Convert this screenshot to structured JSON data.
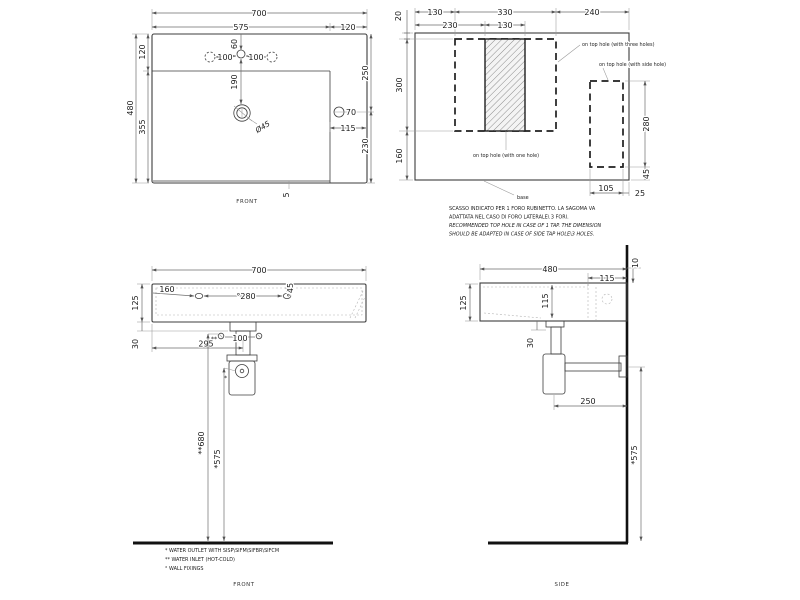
{
  "drawing": {
    "top_view": {
      "caption": "FRONT",
      "width": "700",
      "bowl_width": "575",
      "deck_width": "120",
      "tap_offset": "60",
      "tap_left": "100",
      "tap_right": "100",
      "rim_top": "120",
      "depth": "480",
      "bowl_depth": "355",
      "drain_offset": "190",
      "drain_dia": "Ø45",
      "side_hole": "70",
      "side_hole_inset": "115",
      "side_upper": "250",
      "side_lower": "230",
      "bottom_gap": "5"
    },
    "hole_view": {
      "d20": "20",
      "d130a": "130",
      "d330": "330",
      "d240": "240",
      "d230": "230",
      "d130b": "130",
      "d300": "300",
      "d160": "160",
      "d280": "280",
      "d45": "45",
      "d105": "105",
      "d25": "25",
      "label_three_holes": "on top hole (with three holes)",
      "label_side_hole": "on top hole (with side hole)",
      "label_one_hole": "on top hole (with one hole)",
      "label_base": "base",
      "note_it_1": "SCASSO INDICATO PER 1 FORO RUBINETTO. LA SAGOMA VA",
      "note_it_2": "ADATTATA NEL CASO DI FORO LATERALE\\ 3 FORI.",
      "note_en_1": "RECOMMENDED TOP HOLE IN CASE OF 1 TAP. THE DIMENSION",
      "note_en_2": "SHOULD BE ADAPTED IN CASE OF SIDE TAP HOLE\\3 HOLES."
    },
    "front_view": {
      "caption": "FRONT",
      "width": "700",
      "height": "125",
      "d30": "30",
      "d160": "160",
      "d280": "°280",
      "d45": "°45",
      "d100": "100",
      "d295": "295",
      "d680": "**680",
      "d575": "*575",
      "inlet_mark": "**",
      "outlet_mark": "*",
      "note_outlet": "*  WATER OUTLET WITH SISP\\SIFM\\SIFBR\\SIFCM",
      "note_inlet": "** WATER INLET  (HOT-COLD)",
      "note_fixings": "° WALL FIXINGS"
    },
    "side_view": {
      "caption": "SIDE",
      "width": "480",
      "deck": "115",
      "d10": "10",
      "height": "125",
      "bowl_depth": "115",
      "d30": "30",
      "d250": "250",
      "d575": "*575"
    }
  }
}
